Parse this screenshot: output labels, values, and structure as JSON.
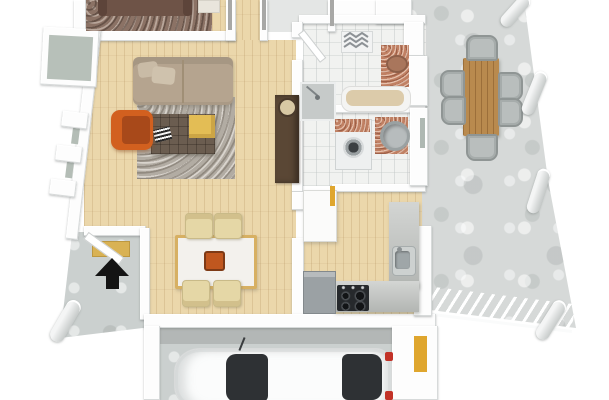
{
  "scene": {
    "description": "3D rendered floor plan of a house viewed from above in slight perspective, no text labels",
    "background": "#ffffff"
  },
  "palette": {
    "wall_white": "#fdfdfd",
    "wood_floor": "#ebd7ab",
    "tile_floor": "#f1f2f0",
    "concrete_patio": "#d6d9d8",
    "concrete_garage": "#cbd0cf",
    "rug_bedroom_brown": "#8b7265",
    "rug_living_gray": "#b2aca3",
    "bed_dark_brown": "#6e5347",
    "sofa_beige": "#b5a48f",
    "armchair_orange": "#d2601f",
    "coffee_table_brown": "#6b5d50",
    "throw_yellow": "#e3bd55",
    "dining_chair_cream": "#e5d7a6",
    "dining_table_top": "#f3f1ed",
    "dining_table_trim": "#d7b063",
    "patio_table_wood": "#b98a4e",
    "patio_chair_gray": "#b9bebd",
    "counter_gray": "#bcbfbc",
    "copper_granite": "#c08063",
    "cooktop_black": "#26292c",
    "appliance_gray": "#9ba1a4",
    "car_white": "#fbfcfc",
    "car_glass": "#2e3134",
    "car_taillight_red": "#c23227",
    "accent_door_yellow": "#dfa62e",
    "doormat_yellow": "#d9b254",
    "window_glass_green": "#b7c0b9",
    "entrance_arrow_black": "#141414"
  },
  "markers": {
    "entrance_arrow": {
      "glyph": "▲",
      "color": "#141414"
    }
  },
  "floorplan": {
    "view": "top-down-3d",
    "rooms": [
      {
        "id": "bedroom",
        "floor": "wood",
        "furniture": [
          "double-bed",
          "area-rug",
          "side-table"
        ]
      },
      {
        "id": "living-room",
        "floor": "wood",
        "furniture": [
          "sofa",
          "shag-rug",
          "coffee-table-ottoman",
          "throw-blanket",
          "magazines",
          "lounge-armchair",
          "tall-cabinet-with-clock"
        ]
      },
      {
        "id": "dining-room",
        "floor": "wood",
        "furniture": [
          "dining-table",
          "dining-chair",
          "dining-chair",
          "dining-chair",
          "dining-chair",
          "centerpiece-bowl"
        ]
      },
      {
        "id": "kitchen",
        "floor": "wood",
        "furniture": [
          "tall-cabinet",
          "l-shaped-counter",
          "sink",
          "cooktop",
          "dishwasher"
        ]
      },
      {
        "id": "bathroom",
        "floor": "tile",
        "furniture": [
          "towel-radiator",
          "copper-vanity-sink",
          "bathtub",
          "shower",
          "open-door"
        ]
      },
      {
        "id": "utility-room",
        "floor": "tile",
        "furniture": [
          "washing-machine",
          "copper-basin-unit"
        ]
      },
      {
        "id": "entrance-porch",
        "floor": "concrete",
        "furniture": [
          "doormat",
          "entrance-arrow-marker",
          "open-front-door",
          "column"
        ]
      },
      {
        "id": "patio",
        "floor": "concrete",
        "furniture": [
          "wooden-outdoor-table",
          "outdoor-chair",
          "outdoor-chair",
          "outdoor-chair",
          "outdoor-chair",
          "outdoor-chair",
          "outdoor-chair",
          "column",
          "column",
          "column",
          "column",
          "railing"
        ]
      },
      {
        "id": "garage",
        "floor": "concrete",
        "furniture": [
          "white-car"
        ]
      }
    ]
  }
}
